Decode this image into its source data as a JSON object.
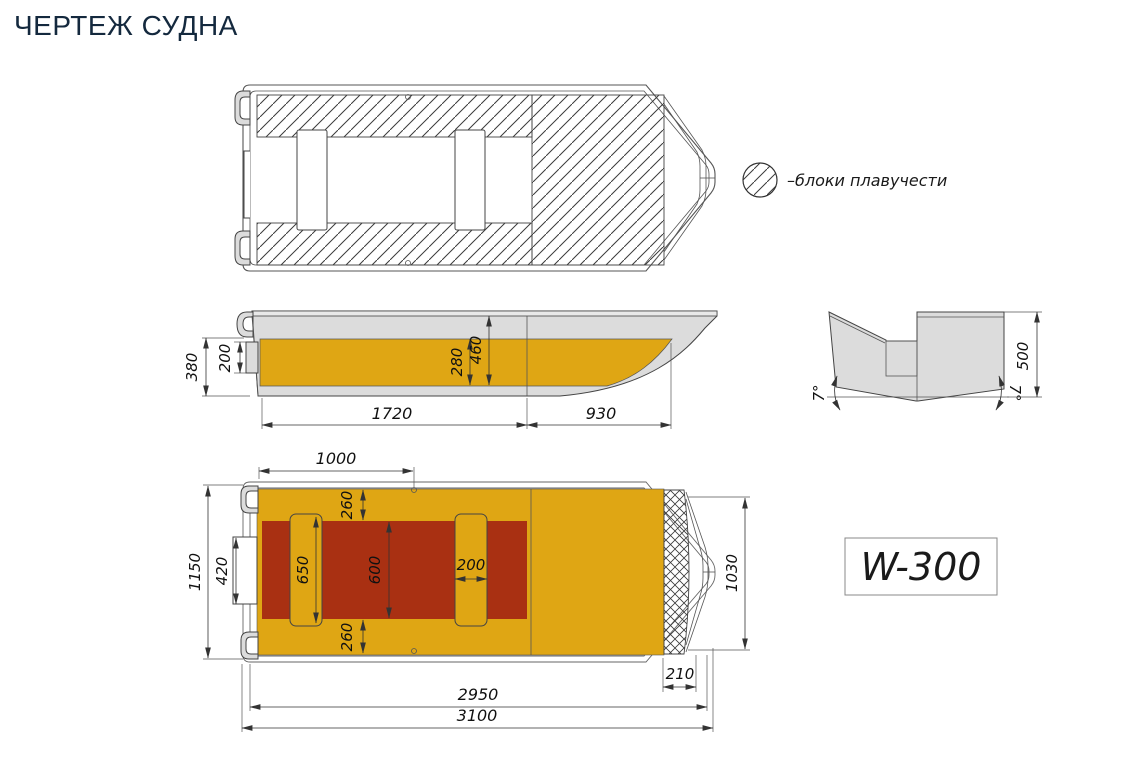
{
  "title": "ЧЕРТЕЖ СУДНА",
  "legend": {
    "label": "–блоки плавучести"
  },
  "model": {
    "label": "W-300"
  },
  "colors": {
    "title": "#14293E",
    "deck_yellow": "#DFA614",
    "cockpit_red": "#A93012",
    "hull_gray": "#DCDCDC",
    "line": "#444444"
  },
  "dims": {
    "side": {
      "depth_transom": "380",
      "motor_mount_height": "200",
      "paint_band_height": "280",
      "depth_mid": "460",
      "aft_section_length": "1720",
      "bow_section_length": "930"
    },
    "transom": {
      "height": "500",
      "deadrise_left": "7°",
      "deadrise_right": "7°"
    },
    "plan": {
      "seat_offset": "1000",
      "side_deck_top": "260",
      "seat_length": "650",
      "cockpit_width": "600",
      "seat_width": "200",
      "motor_mount_width": "420",
      "beam_overall": "1150",
      "side_deck_bottom": "260",
      "bow_beam": "1030",
      "bow_deck_width": "210",
      "hull_length": "2950",
      "overall_length": "3100"
    }
  }
}
